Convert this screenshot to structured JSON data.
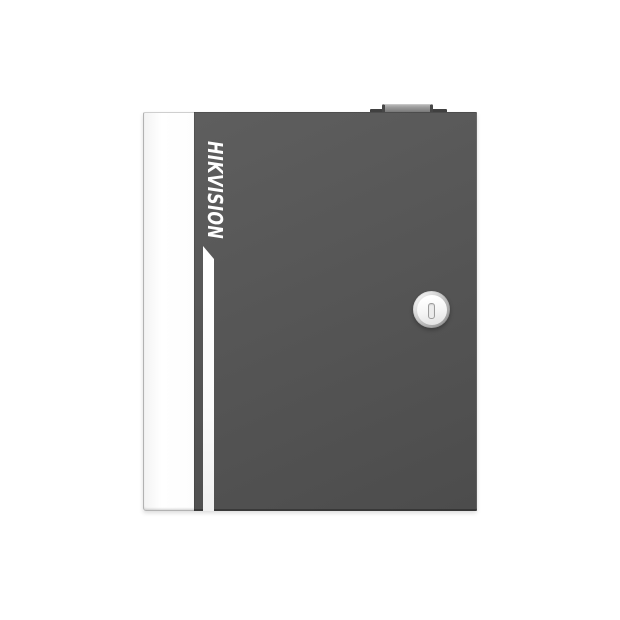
{
  "product": {
    "brand_label": "HIKVISION"
  },
  "icons": {
    "keyhole": "keyhole-icon",
    "lock": "cam-lock",
    "knob": "top-latch-knob"
  },
  "colors": {
    "background": "#ffffff",
    "door_gray": "#565656",
    "door_gray_light": "#5e5e5e",
    "door_gray_dark": "#4c4c4c",
    "panel_white": "#fdfdfd",
    "stripe_white": "#fbfbfb",
    "brand_text": "#ffffff",
    "knob_gray": "#8f8f8f",
    "knob_dark": "#414141",
    "lock_ring": "#bdbdbd",
    "lock_face": "#f4f4f4",
    "keyhole_slot": "#9c9c9c"
  }
}
